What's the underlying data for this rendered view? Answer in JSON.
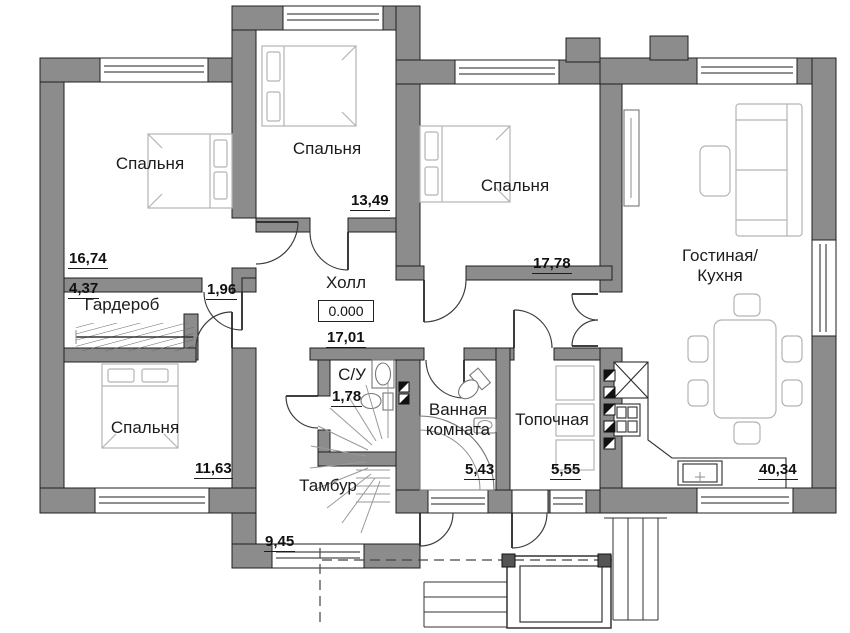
{
  "meta": {
    "type": "floor-plan",
    "elevation_mark": "0.000"
  },
  "colors": {
    "wall": "#8c8c8c",
    "outline": "#1f1f1f",
    "furniture": "#b3b3b3",
    "text": "#1c1c1c",
    "bg": "#ffffff"
  },
  "rooms": {
    "bedroom_top_left": {
      "label": "Спальня",
      "area": "16,74"
    },
    "bedroom_top_mid": {
      "label": "Спальня",
      "area": "13,49"
    },
    "bedroom_top_right": {
      "label": "Спальня",
      "area": "17,78"
    },
    "living_kitchen": {
      "label": "Гостиная/\nКухня",
      "area": "40,34"
    },
    "wardrobe": {
      "label": "Гардероб",
      "area": "4,37"
    },
    "corridor": {
      "area": "1,96"
    },
    "hall": {
      "label": "Холл",
      "elevation": "0.000",
      "area": "17,01"
    },
    "wc": {
      "label": "С/У",
      "area": "1,78"
    },
    "bedroom_bottom_left": {
      "label": "Спальня",
      "area": "11,63"
    },
    "bathroom": {
      "label": "Ванная\nкомната",
      "area": "5,43"
    },
    "boiler_room": {
      "label": "Топочная",
      "area": "5,55"
    },
    "vestibule": {
      "label": "Тамбур",
      "area": "9,45"
    }
  }
}
